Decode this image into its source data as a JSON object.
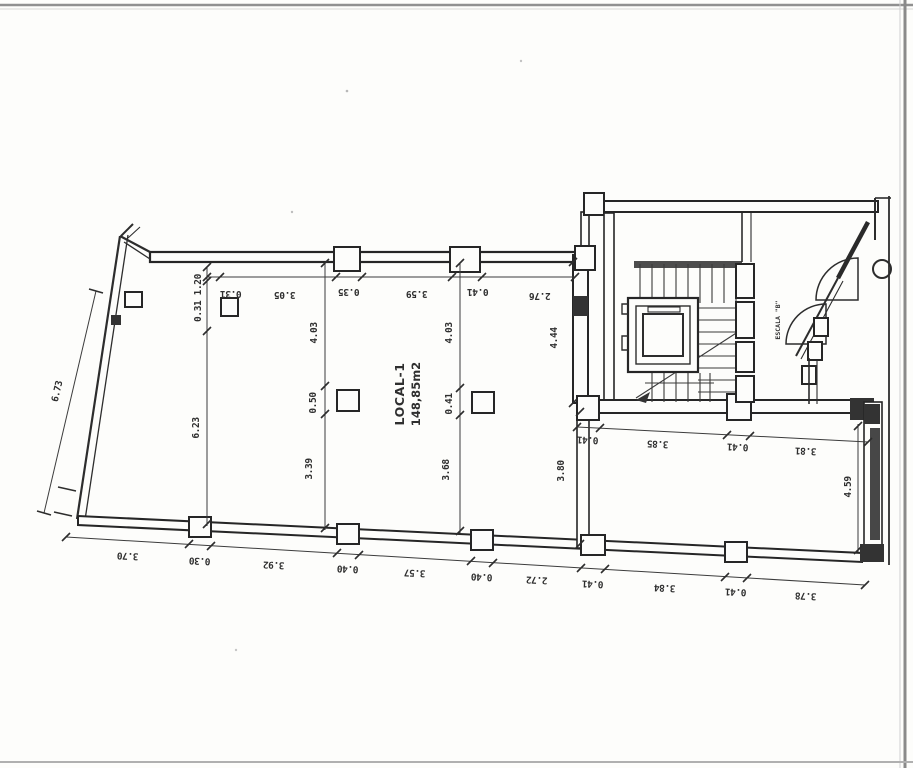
{
  "room": {
    "name": "LOCAL-1",
    "area": "148,85m2"
  },
  "stair": {
    "label": "ESCALA \"B\""
  },
  "dimensions": {
    "top_chain": [
      "0.31",
      "3.05",
      "0.35",
      "3.59",
      "0.41",
      "2.76"
    ],
    "bottom_chain": [
      "3.70",
      "0.30",
      "3.92",
      "0.40",
      "3.57",
      "0.40",
      "2.72",
      "0.41",
      "3.84",
      "0.41",
      "3.78"
    ],
    "left_outer_wall": "6.73",
    "left_inner_upper": "0.31 1.20",
    "left_inner": "6.23",
    "partition_a": [
      "4.03",
      "0.50",
      "3.39"
    ],
    "partition_b": [
      "4.03",
      "0.41",
      "3.68"
    ],
    "stair_wall_upper": "4.44",
    "stair_wall_lower": "3.80",
    "right_room_chain": [
      "0.41",
      "3.85",
      "0.41",
      "3.81"
    ],
    "right_room_depth": "4.59"
  },
  "colors": {
    "ink": "#2d2d2d",
    "paper": "#fdfdfb",
    "scan_edge": "#8a8a8a"
  }
}
